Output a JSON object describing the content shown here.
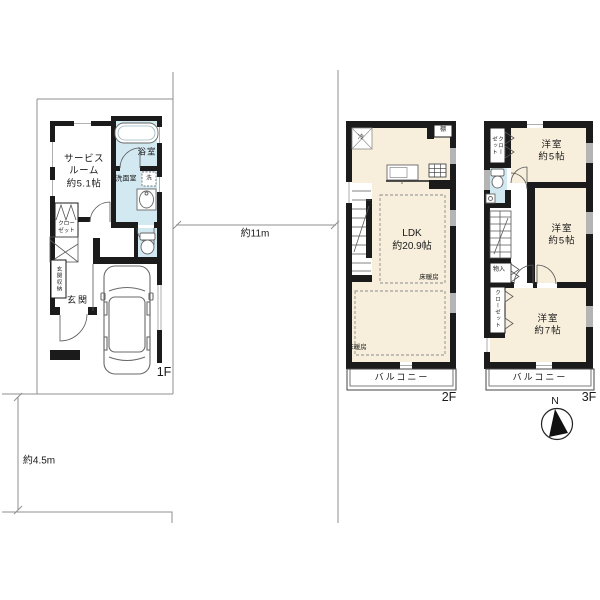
{
  "title": "戸建て間取り図 1F/2F/3F",
  "dimensions": {
    "width_label": "約11m",
    "depth_label": "約4.5m"
  },
  "compass": {
    "north_label": "N"
  },
  "f1": {
    "floor_label": "1F",
    "service_room_label": "サービス\nルーム\n約5.1帖",
    "bath_label": "浴室",
    "washroom_label": "洗面室",
    "washer_label": "洗",
    "closet_label": "クロー\nゼット",
    "entrance_storage_label": "玄関収納",
    "entrance_label": "玄関"
  },
  "f2": {
    "floor_label": "2F",
    "fridge_label": "冷",
    "shelf_label": "棚",
    "ldk_label": "LDK\n約20.9帖",
    "floor_heating_upper_label": "床暖房",
    "floor_heating_lower_label": "床暖房",
    "balcony_label": "バルコニー"
  },
  "f3": {
    "floor_label": "3F",
    "closet_top_label": "クロー\nゼット",
    "room_5_top_label": "洋室\n約5帖",
    "room_5_mid_label": "洋室\n約5帖",
    "room_7_label": "洋室\n約7帖",
    "storage_label": "物入",
    "closet_bottom_label": "クローゼット",
    "balcony_label": "バルコニー"
  },
  "colors": {
    "wall": "#1b1b1b",
    "wet_room_fill": "#d3e9f2",
    "living_room_fill": "#f7eedb",
    "site_line": "#8f8f8f",
    "window_gray": "#b4b4b4"
  }
}
